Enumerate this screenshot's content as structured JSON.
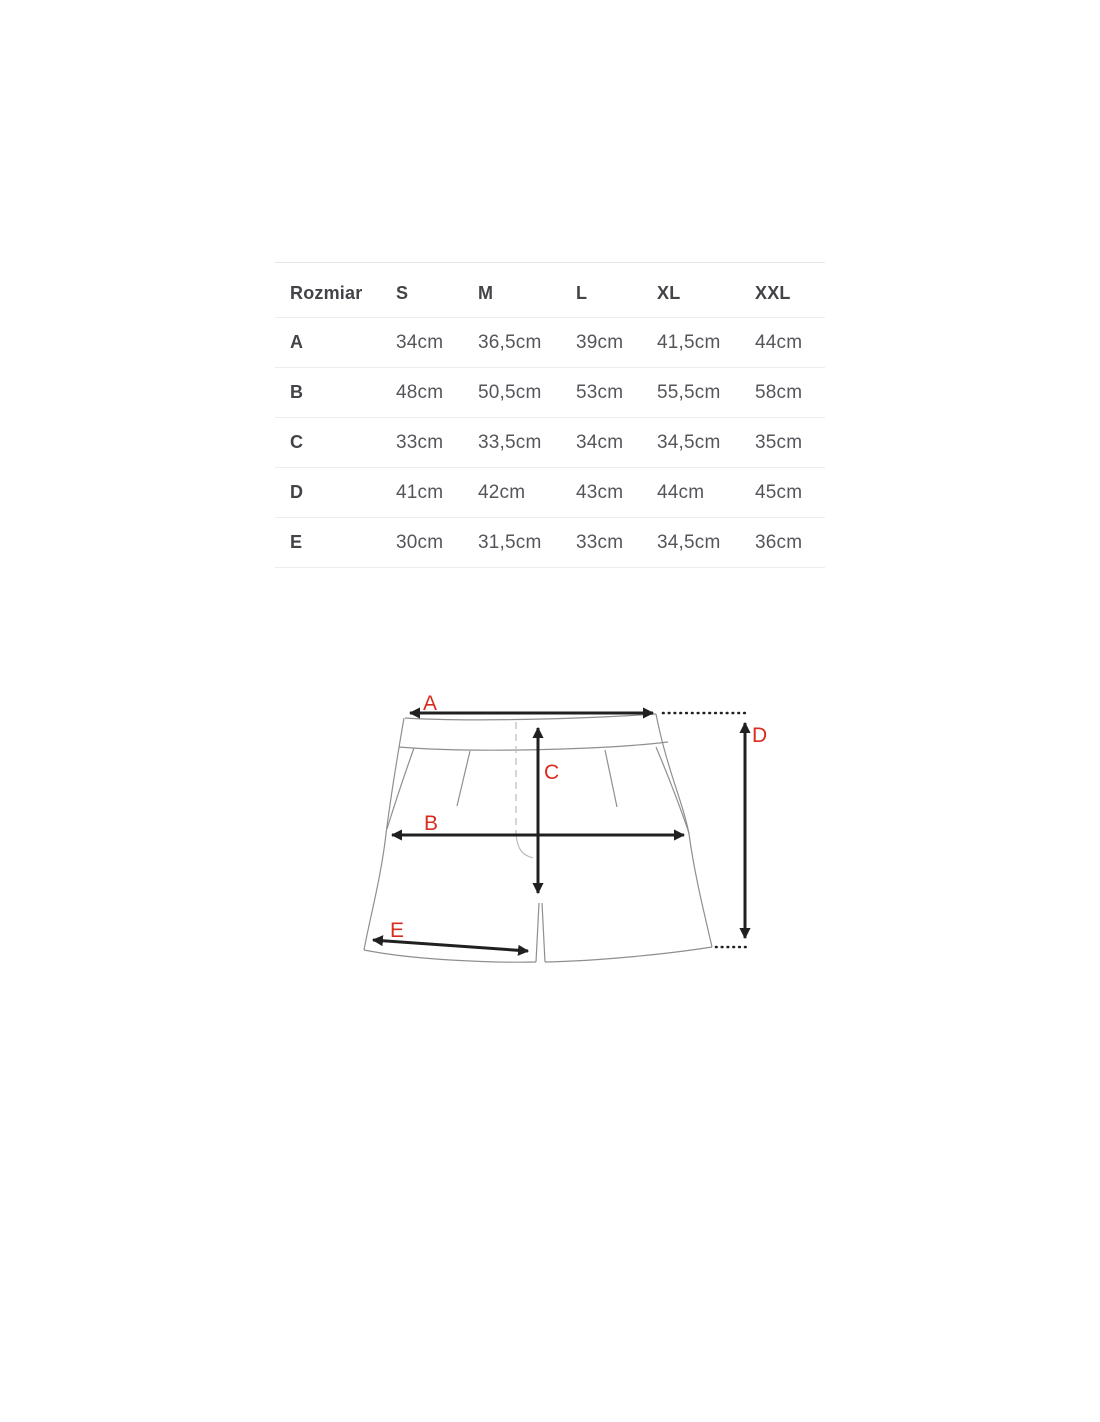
{
  "size_table": {
    "header": [
      "Rozmiar",
      "S",
      "M",
      "L",
      "XL",
      "XXL"
    ],
    "rows": [
      {
        "label": "A",
        "values": [
          "34cm",
          "36,5cm",
          "39cm",
          "41,5cm",
          "44cm"
        ]
      },
      {
        "label": "B",
        "values": [
          "48cm",
          "50,5cm",
          "53cm",
          "55,5cm",
          "58cm"
        ]
      },
      {
        "label": "C",
        "values": [
          "33cm",
          "33,5cm",
          "34cm",
          "34,5cm",
          "35cm"
        ]
      },
      {
        "label": "D",
        "values": [
          "41cm",
          "42cm",
          "43cm",
          "44cm",
          "45cm"
        ]
      },
      {
        "label": "E",
        "values": [
          "30cm",
          "31,5cm",
          "33cm",
          "34,5cm",
          "36cm"
        ]
      }
    ]
  },
  "diagram": {
    "labels": {
      "a": "A",
      "b": "B",
      "c": "C",
      "d": "D",
      "e": "E"
    },
    "label_color": "#d92c1e",
    "arrow_color": "#202020",
    "outline_color": "#8f8f8f"
  }
}
